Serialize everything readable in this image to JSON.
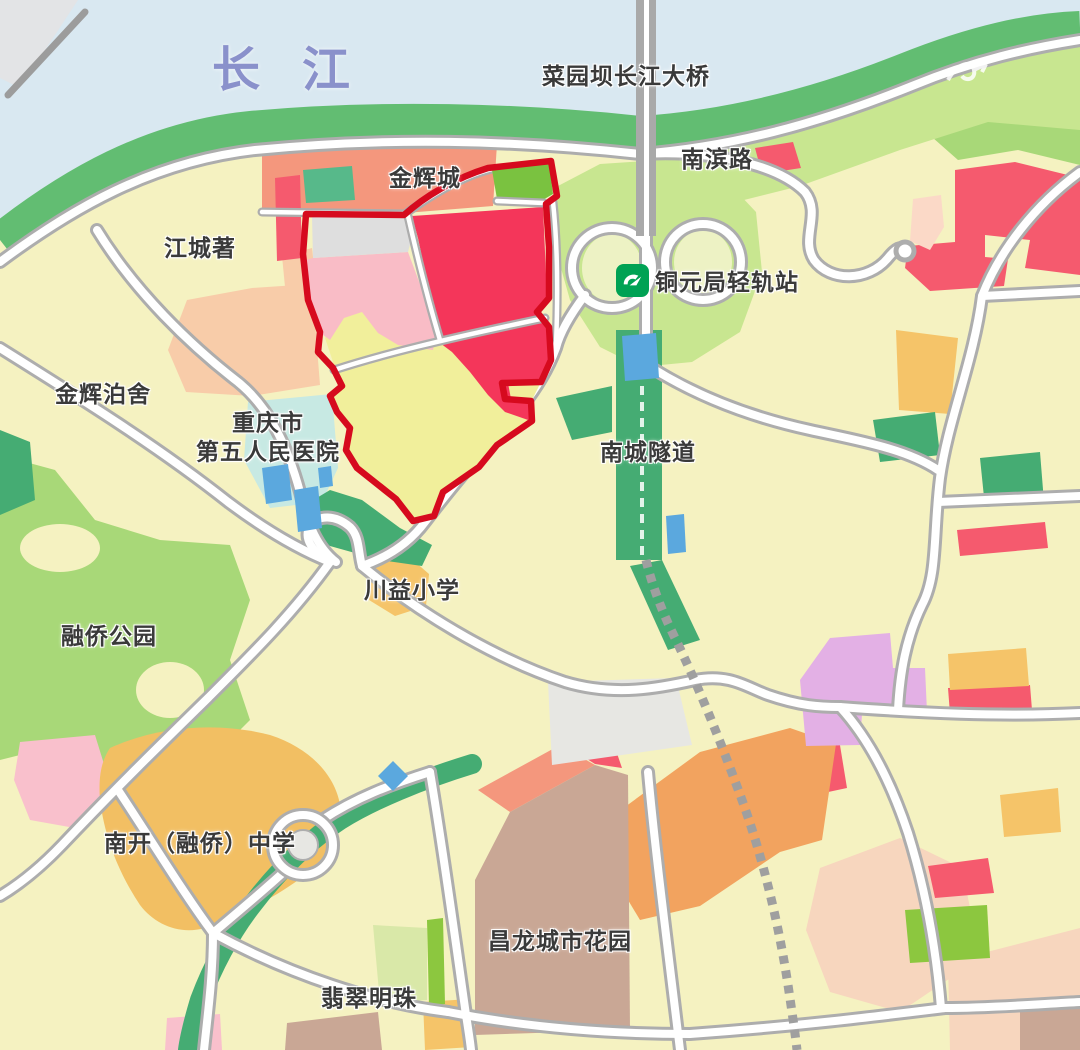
{
  "map": {
    "labels": {
      "river": "长江",
      "bridge": "菜园坝长江大桥",
      "nanbin_road": "南滨路",
      "jinhui_city": "金辉城",
      "jiangchengzhu": "江城著",
      "metro_station": "铜元局轻轨站",
      "jinhui_boshe": "金辉泊舍",
      "hospital_line1": "重庆市",
      "hospital_line2": "第五人民医院",
      "tunnel": "南城隧道",
      "primary_school": "川益小学",
      "park": "融侨公园",
      "middle_school": "南开（融侨）中学",
      "changlong_garden": "昌龙城市花园",
      "feicui_pearl": "翡翠明珠"
    },
    "icons": {
      "metro_logo": "chongqing-rail-transit-icon"
    },
    "colors": {
      "water": "#D9E8F1",
      "river_label": "#8A91CB",
      "bank": "#62BD72",
      "park_green": "#A8D878",
      "pale_park": "#D9E8A8",
      "light_green": "#C8E690",
      "pale_loop": "#EDF2C4",
      "land": "#F5F2C1",
      "road_casing": "#ADADAD",
      "road_white": "#FFFFFF",
      "dark_green": "#45AC73",
      "teal_green": "#57B98A",
      "bright_green": "#7AC240",
      "strip_green": "#8CC73F",
      "outline_red": "#D60A1E",
      "crimson": "#F4365A",
      "parcel_pink": "#F9BCC6",
      "parcel_gray": "#DEDEDE",
      "parcel_yellow": "#F1EF9B",
      "salmon": "#F4977D",
      "peach": "#F8CCA9",
      "pale_peach": "#F7D6BE",
      "orange": "#F5C469",
      "school_orange": "#F2BF63",
      "deep_orange": "#F2A35F",
      "tan": "#C9A795",
      "purple": "#E3B0E5",
      "red_patch": "#F55A6E",
      "light_pink": "#F9C0CC",
      "pale_pink": "#FBD9C7",
      "hospital_cyan": "#C7E9E3",
      "building_blue": "#5BA8DE",
      "vacant_gray": "#E7E7E3",
      "rail_gray": "#9F9F9F",
      "metro_green": "#00A254",
      "label_color": "#3A3A3A"
    }
  }
}
